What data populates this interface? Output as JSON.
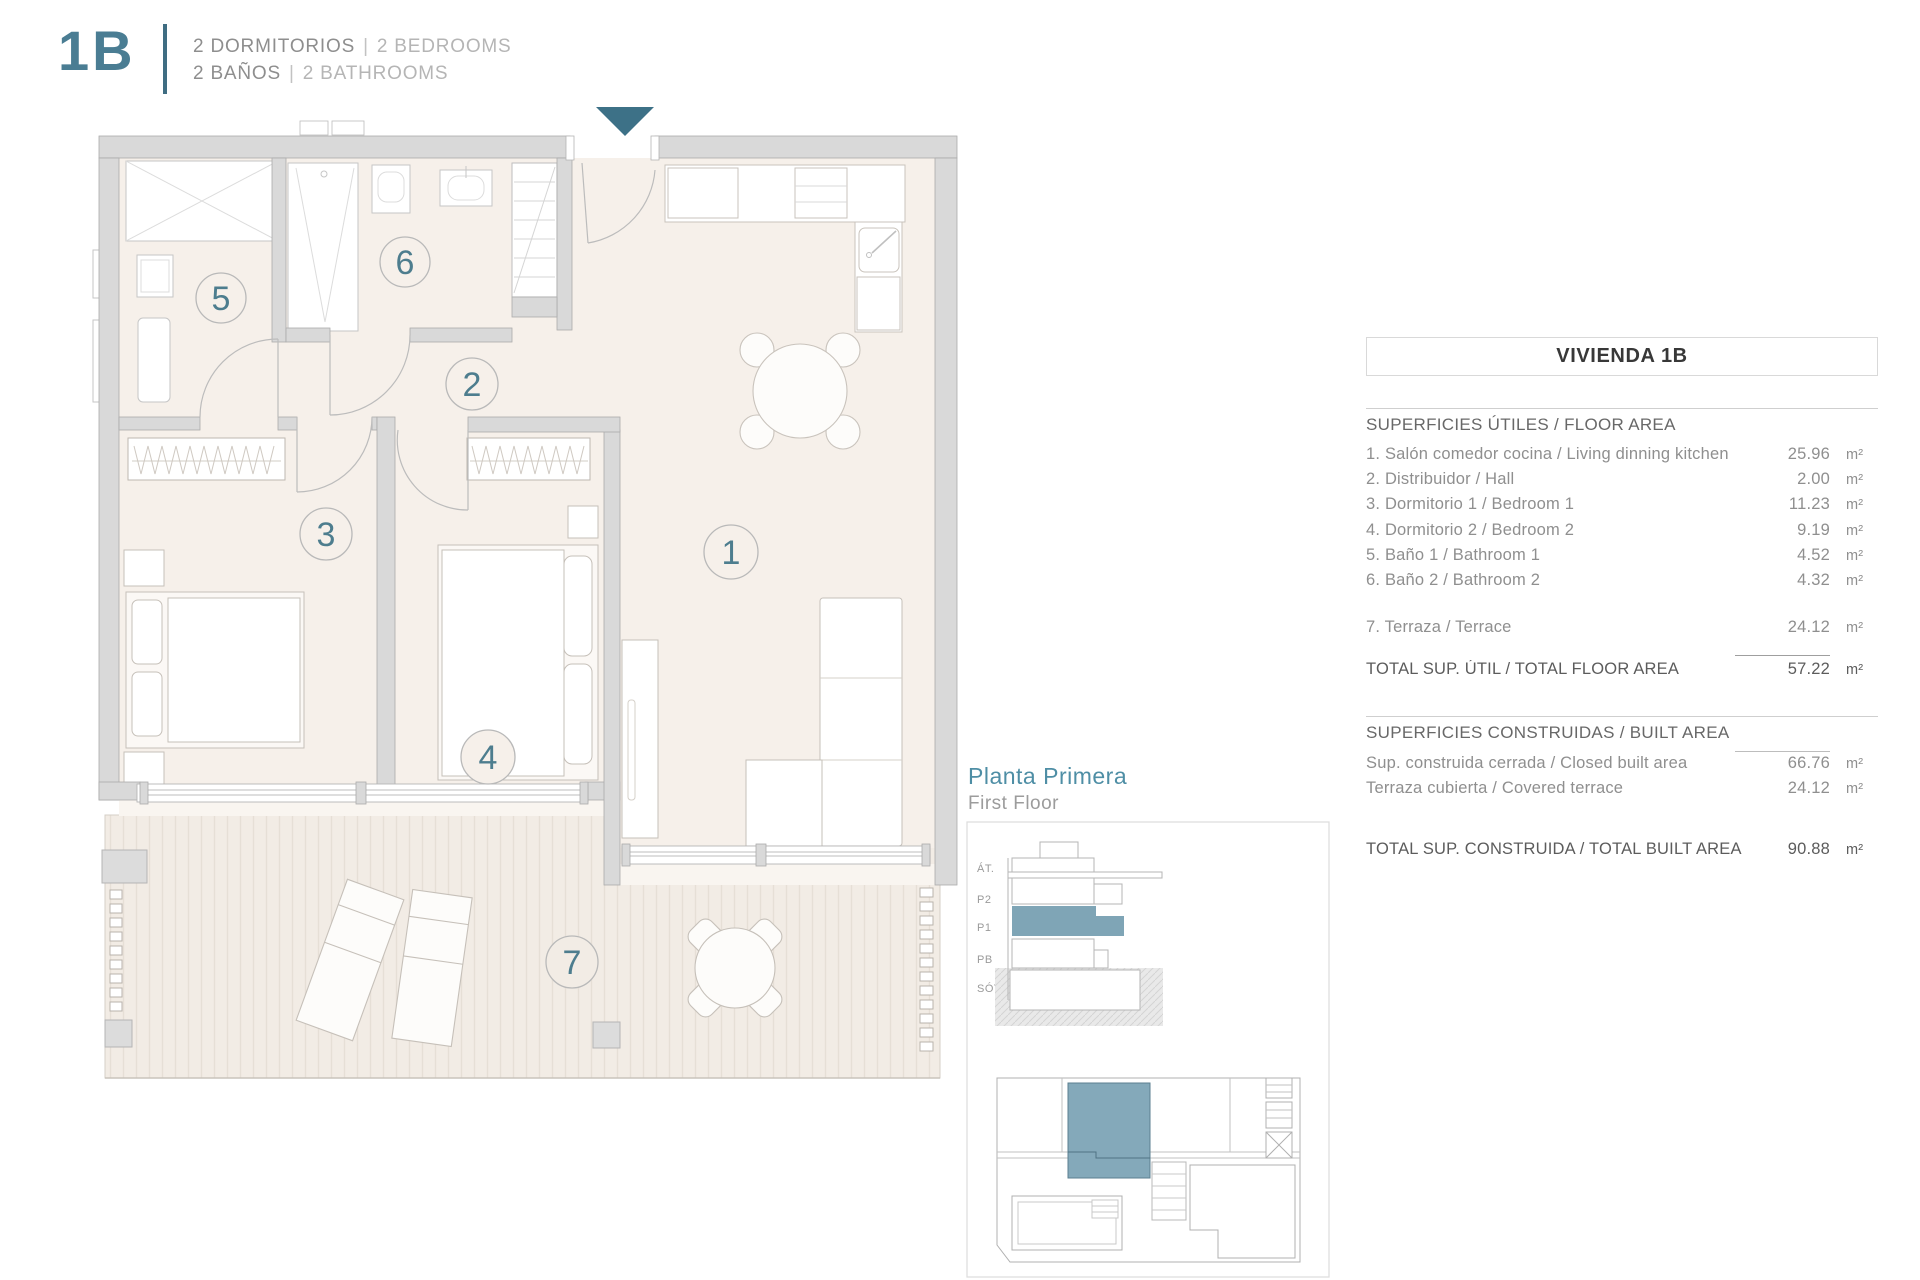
{
  "header": {
    "unit": "1B",
    "line1_primary": "2 DORMITORIOS",
    "line1_sep": "|",
    "line1_secondary": "2 BEDROOMS",
    "line2_primary": "2 BAÑOS",
    "line2_sep": "|",
    "line2_secondary": "2 BATHROOMS"
  },
  "plan": {
    "room_numbers": [
      "1",
      "2",
      "3",
      "4",
      "5",
      "6",
      "7"
    ]
  },
  "floor_label": {
    "es": "Planta Primera",
    "en": "First Floor"
  },
  "elevation": {
    "levels": [
      "ÁT.",
      "P2",
      "P1",
      "PB",
      "SÓT."
    ]
  },
  "table": {
    "title": "VIVIENDA 1B",
    "floor_area_section": "SUPERFICIES ÚTILES / FLOOR AREA",
    "rows": [
      {
        "label": "1. Salón comedor cocina / Living dinning kitchen",
        "value": "25.96",
        "unit": "m²"
      },
      {
        "label": "2. Distribuidor / Hall",
        "value": "2.00",
        "unit": "m²"
      },
      {
        "label": "3. Dormitorio 1 / Bedroom 1",
        "value": "11.23",
        "unit": "m²"
      },
      {
        "label": "4. Dormitorio 2 / Bedroom 2",
        "value": "9.19",
        "unit": "m²"
      },
      {
        "label": "5. Baño 1 / Bathroom 1",
        "value": "4.52",
        "unit": "m²"
      },
      {
        "label": "6. Baño 2 / Bathroom 2",
        "value": "4.32",
        "unit": "m²"
      }
    ],
    "terrace_row": {
      "label": "7. Terraza / Terrace",
      "value": "24.12",
      "unit": "m²"
    },
    "total_floor": {
      "label": "TOTAL SUP. ÚTIL / TOTAL FLOOR AREA",
      "value": "57.22",
      "unit": "m²"
    },
    "built_section": "SUPERFICIES CONSTRUIDAS / BUILT AREA",
    "built_rows": [
      {
        "label": "Sup. construida cerrada / Closed built area",
        "value": "66.76",
        "unit": "m²"
      },
      {
        "label": "Terraza cubierta / Covered terrace",
        "value": "24.12",
        "unit": "m²"
      }
    ],
    "total_built": {
      "label": "TOTAL SUP. CONSTRUIDA /  TOTAL BUILT AREA",
      "value": "90.88",
      "unit": "m²"
    }
  },
  "colors": {
    "accent_teal": "#3f6d82",
    "room_number_teal": "#4d7d8e",
    "highlight_fill": "#7fa5b6",
    "wall_gray": "#d9d9d9",
    "floor_beige": "#f6f0ea"
  }
}
